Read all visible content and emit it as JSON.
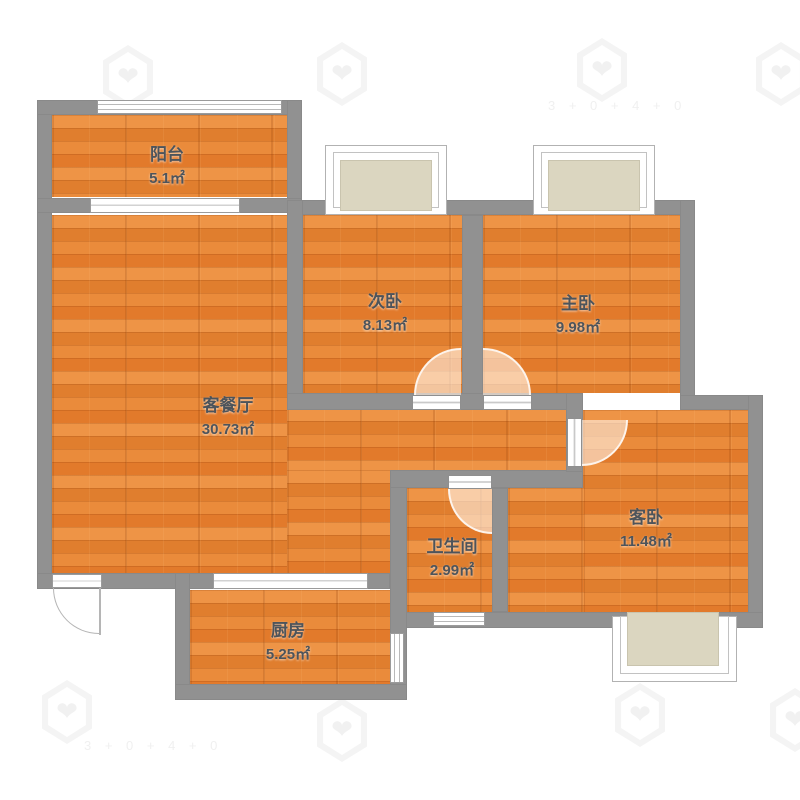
{
  "rooms": {
    "balcony": {
      "name": "阳台",
      "area": "5.1㎡"
    },
    "living_dining": {
      "name": "客餐厅",
      "area": "30.73㎡"
    },
    "second_bedroom": {
      "name": "次卧",
      "area": "8.13㎡"
    },
    "master_bedroom": {
      "name": "主卧",
      "area": "9.98㎡"
    },
    "bathroom": {
      "name": "卫生间",
      "area": "2.99㎡"
    },
    "guest_bedroom": {
      "name": "客卧",
      "area": "11.48㎡"
    },
    "kitchen": {
      "name": "厨房",
      "area": "5.25㎡"
    }
  },
  "watermark": {
    "icon": "shield-heart-logo",
    "text": "3 + 0 + 4 + 0"
  },
  "colors": {
    "wall": "#919191",
    "floor_wood": "#e8873a",
    "bay_fill": "#dbd6c0",
    "door_swing": "#f6dfc9",
    "label_text": "#4d545b",
    "background": "#ffffff"
  }
}
